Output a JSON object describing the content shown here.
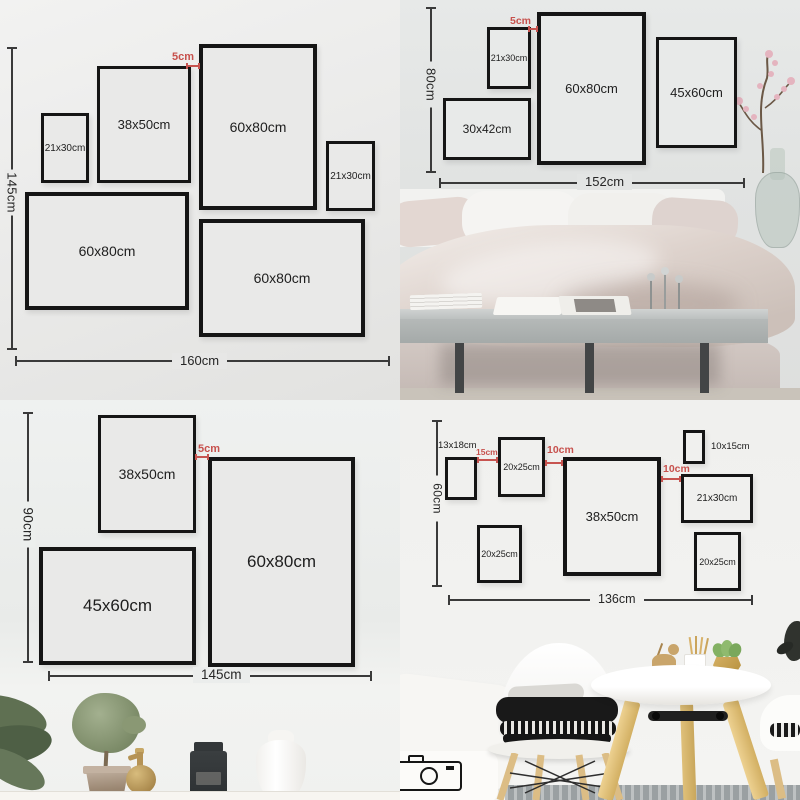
{
  "colors": {
    "accent_red": "#c7514d",
    "frame_border": "#151515",
    "dimension_line": "#3a3a3a",
    "wall_light": "#ededec"
  },
  "quadrants": {
    "top_left": {
      "height_label": "145cm",
      "width_label": "160cm",
      "gap_label": "5cm",
      "frames": [
        "21x30cm",
        "38x50cm",
        "60x80cm",
        "21x30cm",
        "60x80cm",
        "60x80cm"
      ]
    },
    "top_right": {
      "height_label": "80cm",
      "width_label": "152cm",
      "gap_label": "5cm",
      "frames": [
        "21x30cm",
        "60x80cm",
        "45x60cm",
        "30x42cm"
      ]
    },
    "bottom_left": {
      "height_label": "90cm",
      "width_label": "145cm",
      "gap_label": "5cm",
      "frames": [
        "38x50cm",
        "60x80cm",
        "45x60cm"
      ]
    },
    "bottom_right": {
      "height_label": "60cm",
      "width_label": "136cm",
      "gap_labels": [
        "15cm",
        "10cm",
        "10cm"
      ],
      "callout_labels": [
        "13x18cm",
        "10x15cm"
      ],
      "frames": [
        "20x25cm",
        "38x50cm",
        "21x30cm",
        "20x25cm",
        "20x25cm"
      ]
    }
  }
}
